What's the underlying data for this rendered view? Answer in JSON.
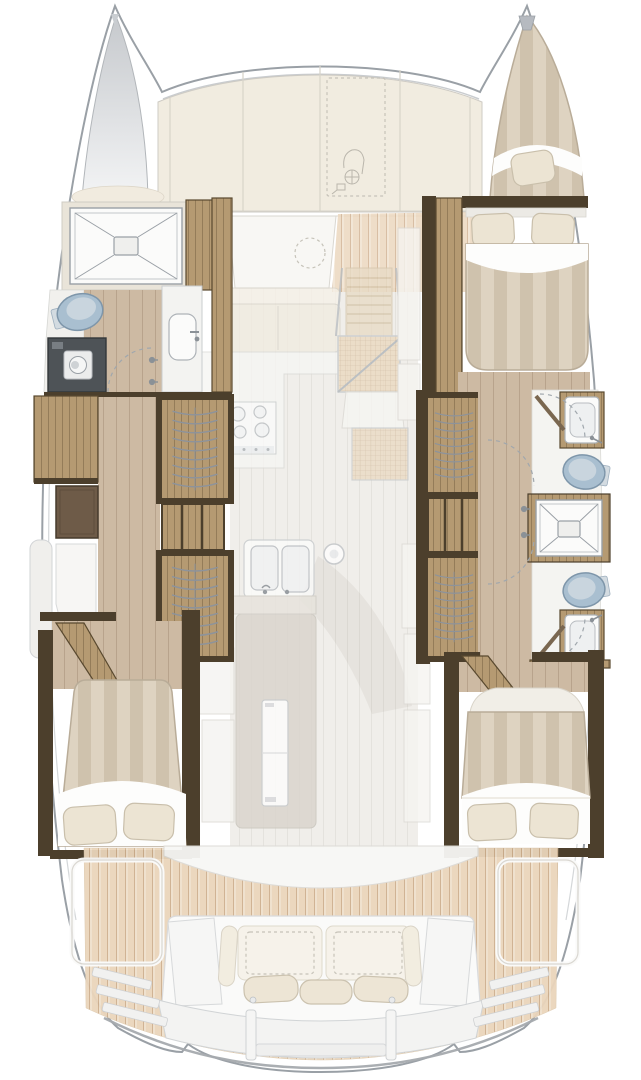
{
  "title": "Sailing catamaran interior layout floor plan, top view",
  "colors": {
    "hull_line": "#9aa0a6",
    "hull_inner": "#c9cccf",
    "ghost_line": "#d1cec7",
    "cream": "#f1ebdf",
    "cream_shade": "#e9e2d3",
    "deck_plank": "#ead5bb",
    "deck_plank_line": "#c7a683",
    "floor_wood": "#cdbaa3",
    "floor_wood_line": "#b6a189",
    "wood": "#b59a72",
    "wood_dark": "#59492f",
    "wall_dark": "#4c3f2c",
    "arc_line": "#8d939b",
    "mattress_a": "#ded3c1",
    "mattress_b": "#cfc2ad",
    "sheet": "#fdfdfc",
    "pillow": "#ece4d3",
    "pillow_edge": "#c9bfab",
    "toilet_body": "#a9bfd0",
    "toilet_rim": "#7e96aa",
    "toilet_inner": "#c9d5de",
    "fixture_white": "#fbfbfa",
    "fixture_line": "#aeb3b8",
    "appliance_dark": "#4e5357",
    "bow_top": "#c6c9cd",
    "bow_bottom": "#f3f4f5",
    "saloon_floor": "#f0eeea"
  },
  "plan": {
    "vessel_type": "sailing catamaran deck plan (two hulls, bridgedeck saloon, aft cockpit)",
    "port_hull": {
      "forward": [
        "shower-cubicle",
        "toilet",
        "washing-machine",
        "washbasin"
      ],
      "midship": [
        "hanging-wardrobes",
        "shelf-unit",
        "dresser-cabinet",
        "seat"
      ],
      "aft": [
        "double-berth-with-pillows"
      ]
    },
    "starboard_hull": {
      "forward": [
        "bow-single-berth",
        "double-berth-with-pillows"
      ],
      "midship": [
        "hanging-wardrobes",
        "shelf-unit",
        "bathroom-forward",
        "shared-shower-cubicle",
        "bathroom-aft"
      ],
      "aft": [
        "double-berth-with-pillows"
      ]
    },
    "main_deck": [
      "foredeck-panels",
      "anchor-windlass-outline",
      "forward-lounge-seat",
      "saloon-sofa",
      "cooktop",
      "companionway-steps",
      "galley-double-sink",
      "round-sink",
      "refrigerator",
      "galley-island"
    ],
    "cockpit": [
      "aft-bench-sofa",
      "back-cushions",
      "seat-cushions",
      "deck-hatch-outlines",
      "teak-decking",
      "transom-steps",
      "swim-platform"
    ]
  }
}
